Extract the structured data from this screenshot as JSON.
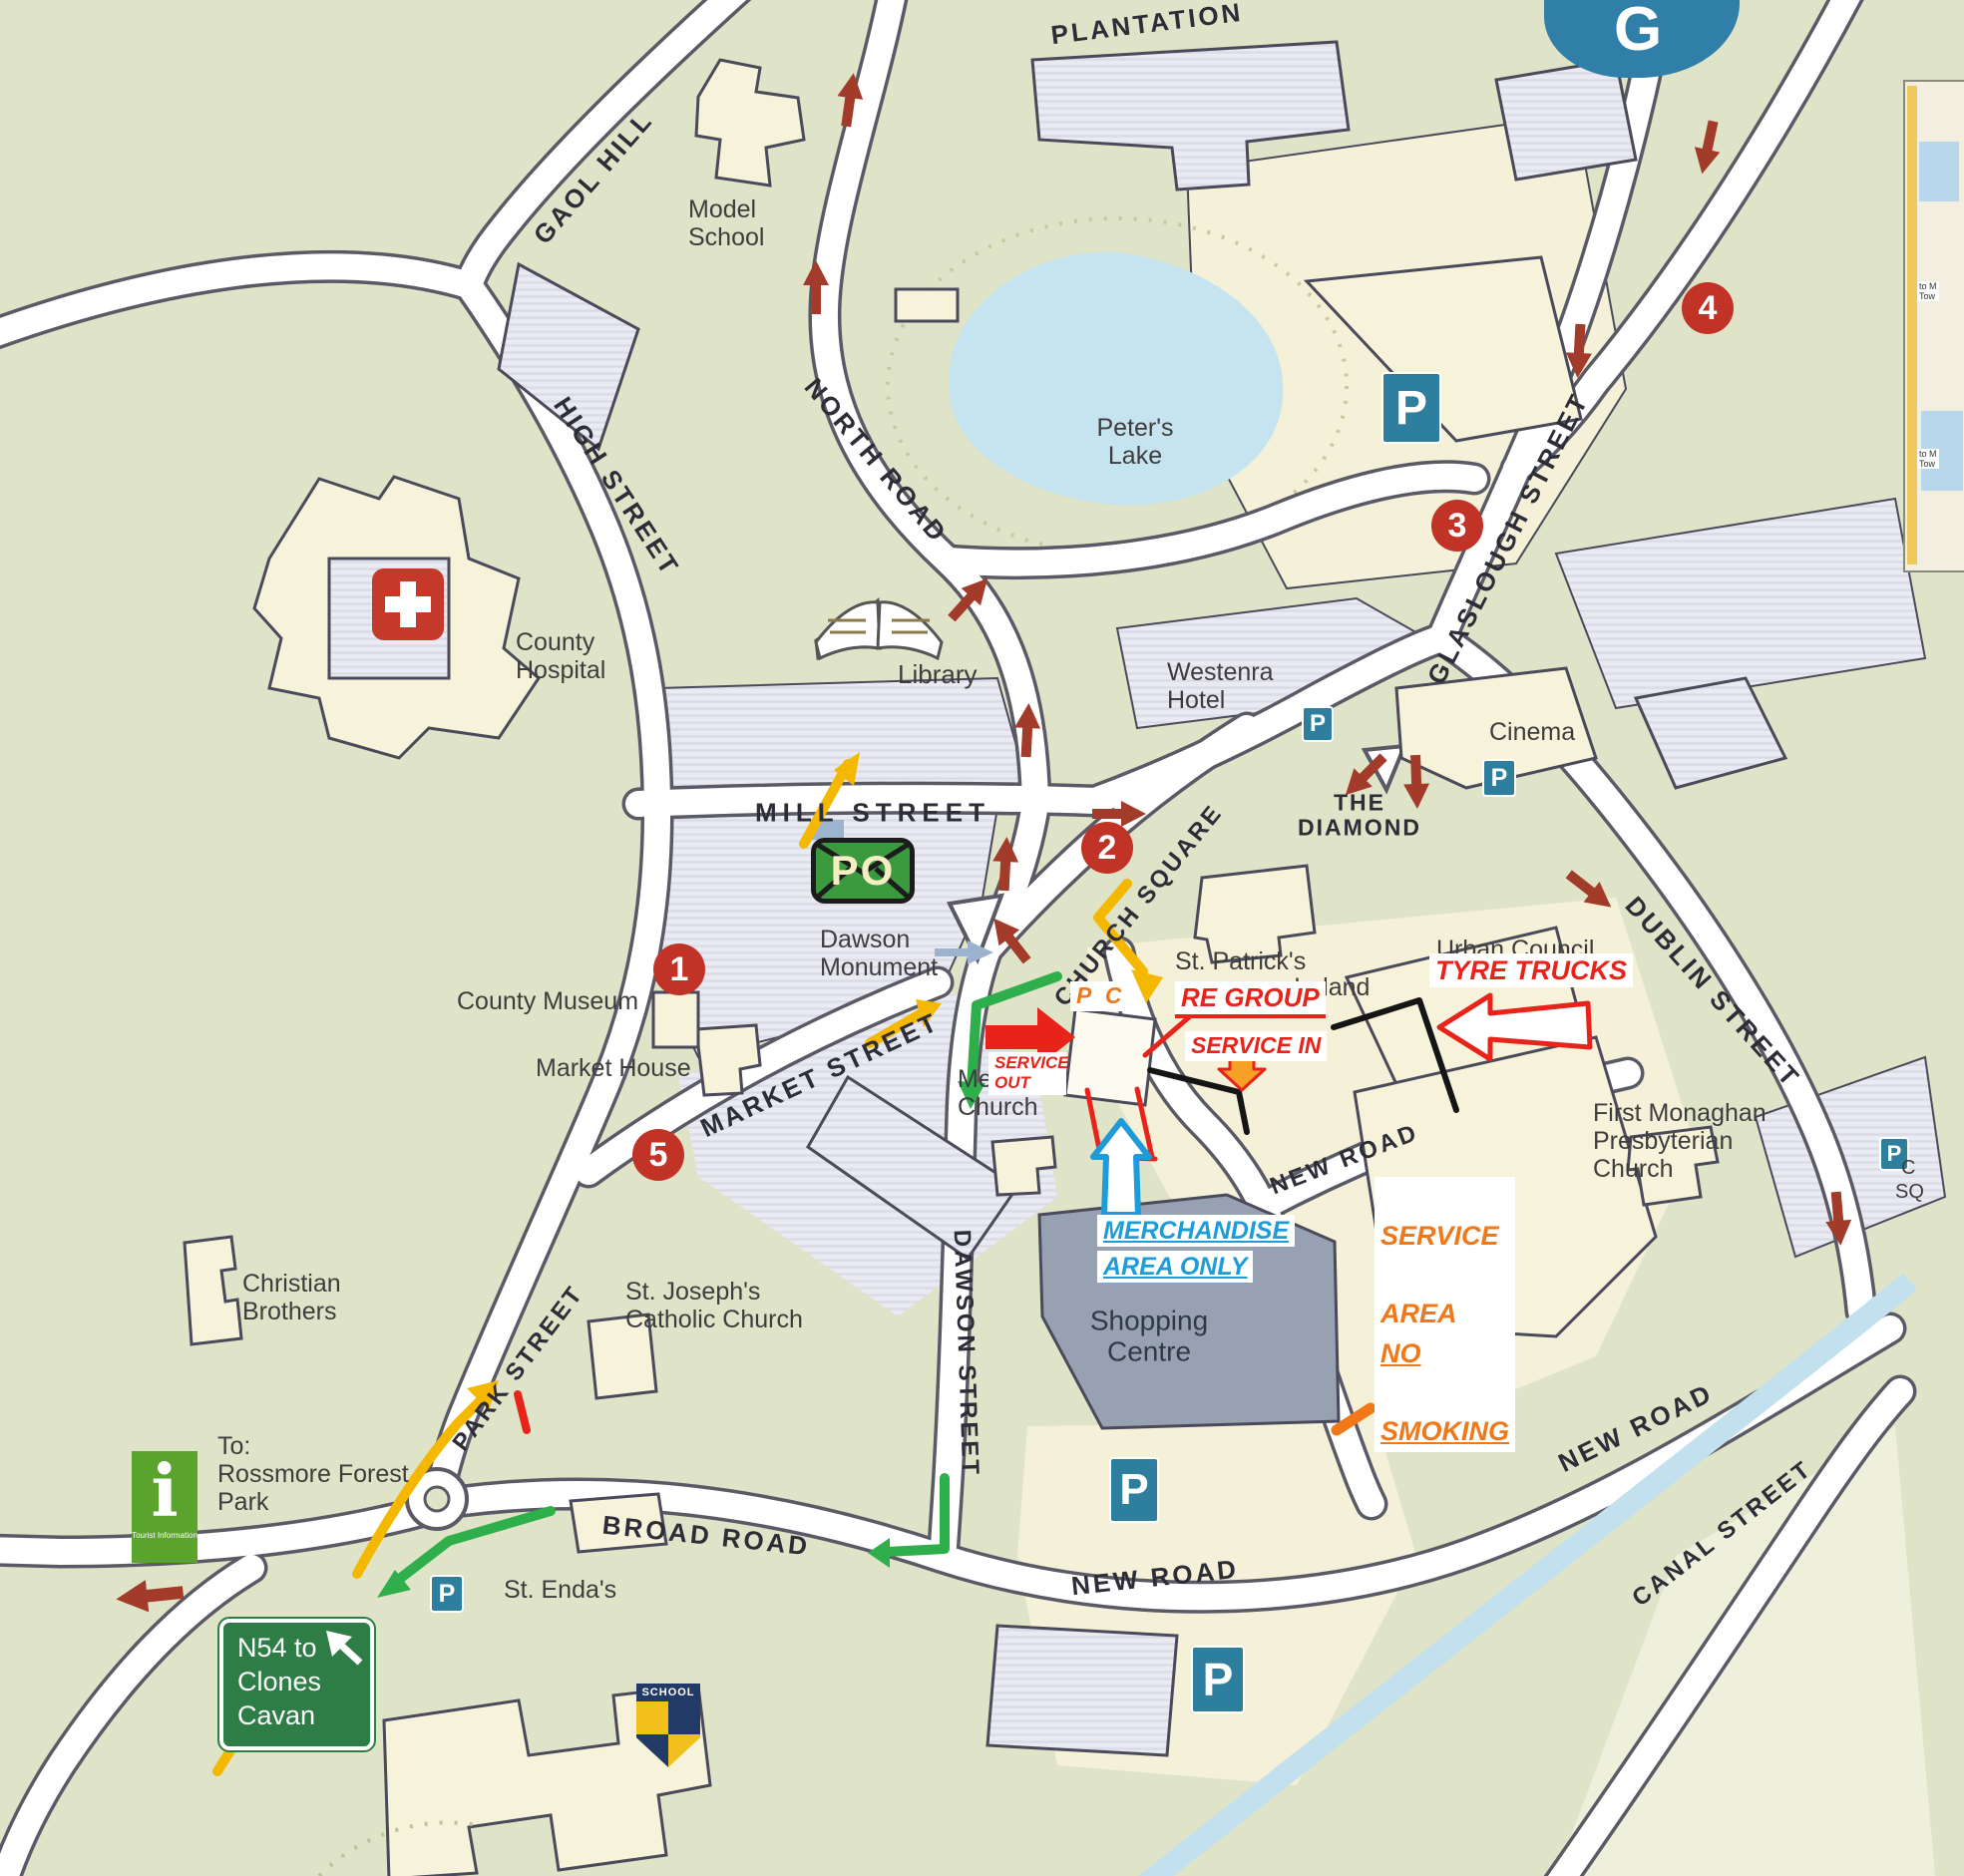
{
  "streets": {
    "gaol_hill": "GAOL HILL",
    "high_street": "HIGH STREET",
    "north_road": "NORTH ROAD",
    "plantation": "PLANTATION",
    "mill_street": "MILL STREET",
    "market_street": "MARKET STREET",
    "church_square": "CHURCH SQUARE",
    "the_diamond": "THE\nDIAMOND",
    "glaslough_street": "GLASLOUGH STREET",
    "dublin_street": "DUBLIN STREET",
    "dawson_street": "DAWSON STREET",
    "park_street": "PARK STREET",
    "broad_road": "BROAD ROAD",
    "new_road_south": "NEW ROAD",
    "new_road_upper": "NEW ROAD",
    "new_road_east": "NEW ROAD",
    "canal_street": "CANAL STREET"
  },
  "places": {
    "model_school": "Model\nSchool",
    "peters_lake": "Peter's\nLake",
    "library": "Library",
    "county_hospital": "County\nHospital",
    "county_museum": "County Museum",
    "market_house": "Market House",
    "dawson_monument": "Dawson\nMonument",
    "westenra_hotel": "Westenra\nHotel",
    "cinema": "Cinema",
    "urban_council": "Urban Council",
    "st_patricks": "St. Patrick's",
    "ireland": "Ireland",
    "methodist_church": "Methodist\nChurch",
    "first_presbyterian": "First Monaghan\nPresbyterian\nChurch",
    "christian_brothers": "Christian\nBrothers",
    "st_josephs": "St. Joseph's\nCatholic Church",
    "shopping_centre": "Shopping\nCentre",
    "st_endas": "St. Enda's",
    "rossmore": "To:\nRossmore Forest\nPark"
  },
  "badges": {
    "b1": "1",
    "b2": "2",
    "b3": "3",
    "b4": "4",
    "b5": "5"
  },
  "icons": {
    "parking": "P",
    "post_office": "PO",
    "info": "i",
    "info_caption": "Tourist Information",
    "school_shield": "SCHOOL",
    "g_logo": "G"
  },
  "signs": {
    "n54": "N54 to\nClones\nCavan"
  },
  "annotations": {
    "service_out": "SERVICE\nOUT",
    "re_group": "RE GROUP",
    "service_in": "SERVICE  IN",
    "tyre_trucks": "TYRE TRUCKS",
    "merchandise_line1": "MERCHANDISE",
    "merchandise_line2": "AREA ONLY",
    "pc": "P C",
    "service_area_line1": "SERVICE",
    "service_area_line2a": "AREA",
    "service_area_line2b": "NO",
    "service_area_line3": "SMOKING"
  },
  "edge_fragments": {
    "f1": "to M\nTow",
    "f2": "to M\nTow",
    "c": "C",
    "sq": "SQ"
  },
  "colors": {
    "land": "#dfe3c8",
    "road": "#ffffff",
    "building": "#f7f2da",
    "block": "#e9e9f1",
    "shopping": "#97a1b2",
    "lake": "#c6e3f0",
    "annotation_red": "#e8231a",
    "annotation_yellow": "#f5b800",
    "annotation_green": "#2eaf4b",
    "annotation_blue": "#1e9cd7",
    "annotation_orange": "#f07818",
    "map_arrow": "#a23b2a",
    "badge": "#c13327",
    "parking_blue": "#2e7f9e",
    "po_green": "#3a9a3d",
    "info_green": "#5aa32c",
    "sign_green": "#2e7d46"
  }
}
